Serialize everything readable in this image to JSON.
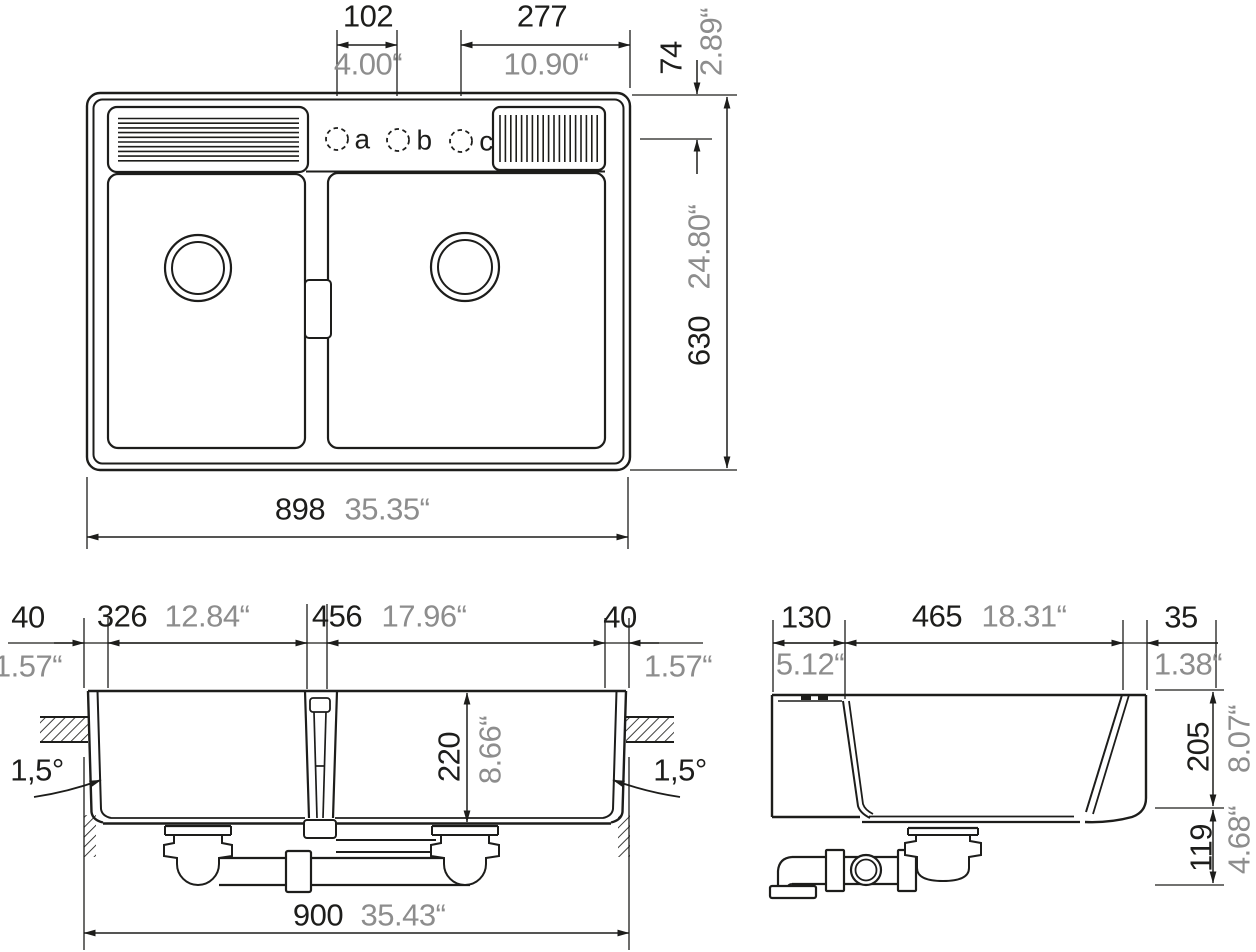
{
  "colors": {
    "line": "#1d1d1b",
    "dim_gray": "#8d8d8d",
    "background": "#ffffff"
  },
  "plan_view": {
    "hole_pitch_mm": "102",
    "hole_pitch_in": "4.00“",
    "hole_to_edge_mm": "277",
    "hole_to_edge_in": "10.90“",
    "edge_to_holes_mm": "74",
    "edge_to_holes_in": "2.89“",
    "depth_mm": "630",
    "depth_in": "24.80“",
    "width_mm": "898",
    "width_in": "35.35“",
    "tap_holes": [
      "a",
      "b",
      "c"
    ]
  },
  "front_section": {
    "left_rim_mm": "40",
    "left_rim_in": "1.57“",
    "left_bowl_mm": "326",
    "left_bowl_in": "12.84“",
    "right_bowl_mm": "456",
    "right_bowl_in": "17.96“",
    "right_rim_mm": "40",
    "right_rim_in": "1.57“",
    "bowl_depth_mm": "220",
    "bowl_depth_in": "8.66“",
    "taper_left": "1,5°",
    "taper_right": "1,5°",
    "overall_mm": "900",
    "overall_in": "35.43“"
  },
  "side_section": {
    "front_ledge_mm": "130",
    "front_ledge_in": "5.12“",
    "bowl_mm": "465",
    "bowl_in": "18.31“",
    "back_rim_mm": "35",
    "back_rim_in": "1.38“",
    "bowl_depth_mm": "205",
    "bowl_depth_in": "8.07“",
    "drain_height_mm": "119",
    "drain_height_in": "4.68“"
  }
}
